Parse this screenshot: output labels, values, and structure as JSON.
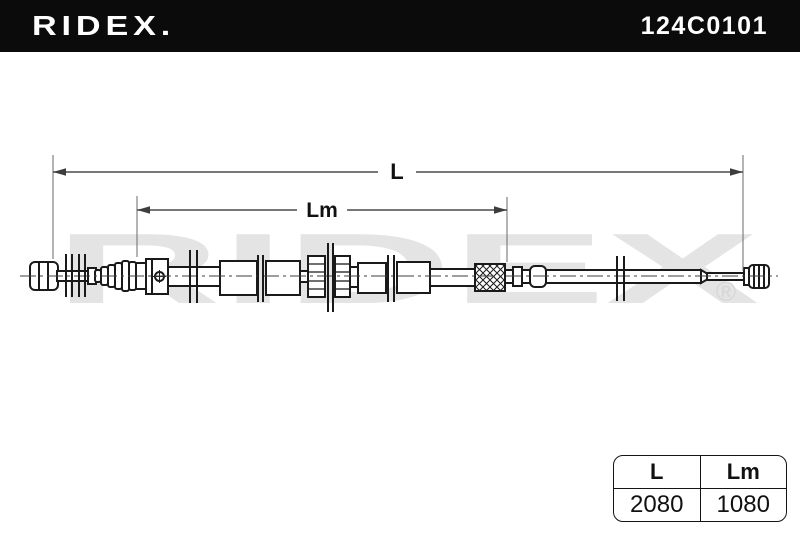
{
  "header": {
    "brand": "RIDEX.",
    "part_number": "124C0101"
  },
  "diagram": {
    "watermark": "RIDEX",
    "watermark_mark": "®",
    "dim_l": {
      "label": "L",
      "value": "2080"
    },
    "dim_lm": {
      "label": "Lm",
      "value": "1080"
    }
  },
  "table": {
    "columns": [
      "L",
      "Lm"
    ],
    "rows": [
      [
        "2080",
        "1080"
      ]
    ]
  },
  "colors": {
    "header_bg": "#0b0b0b",
    "header_fg": "#ffffff",
    "drawing_line": "#1a1a1a",
    "dimension_line": "#4a4a4a",
    "watermark": "#e4e4e4"
  }
}
